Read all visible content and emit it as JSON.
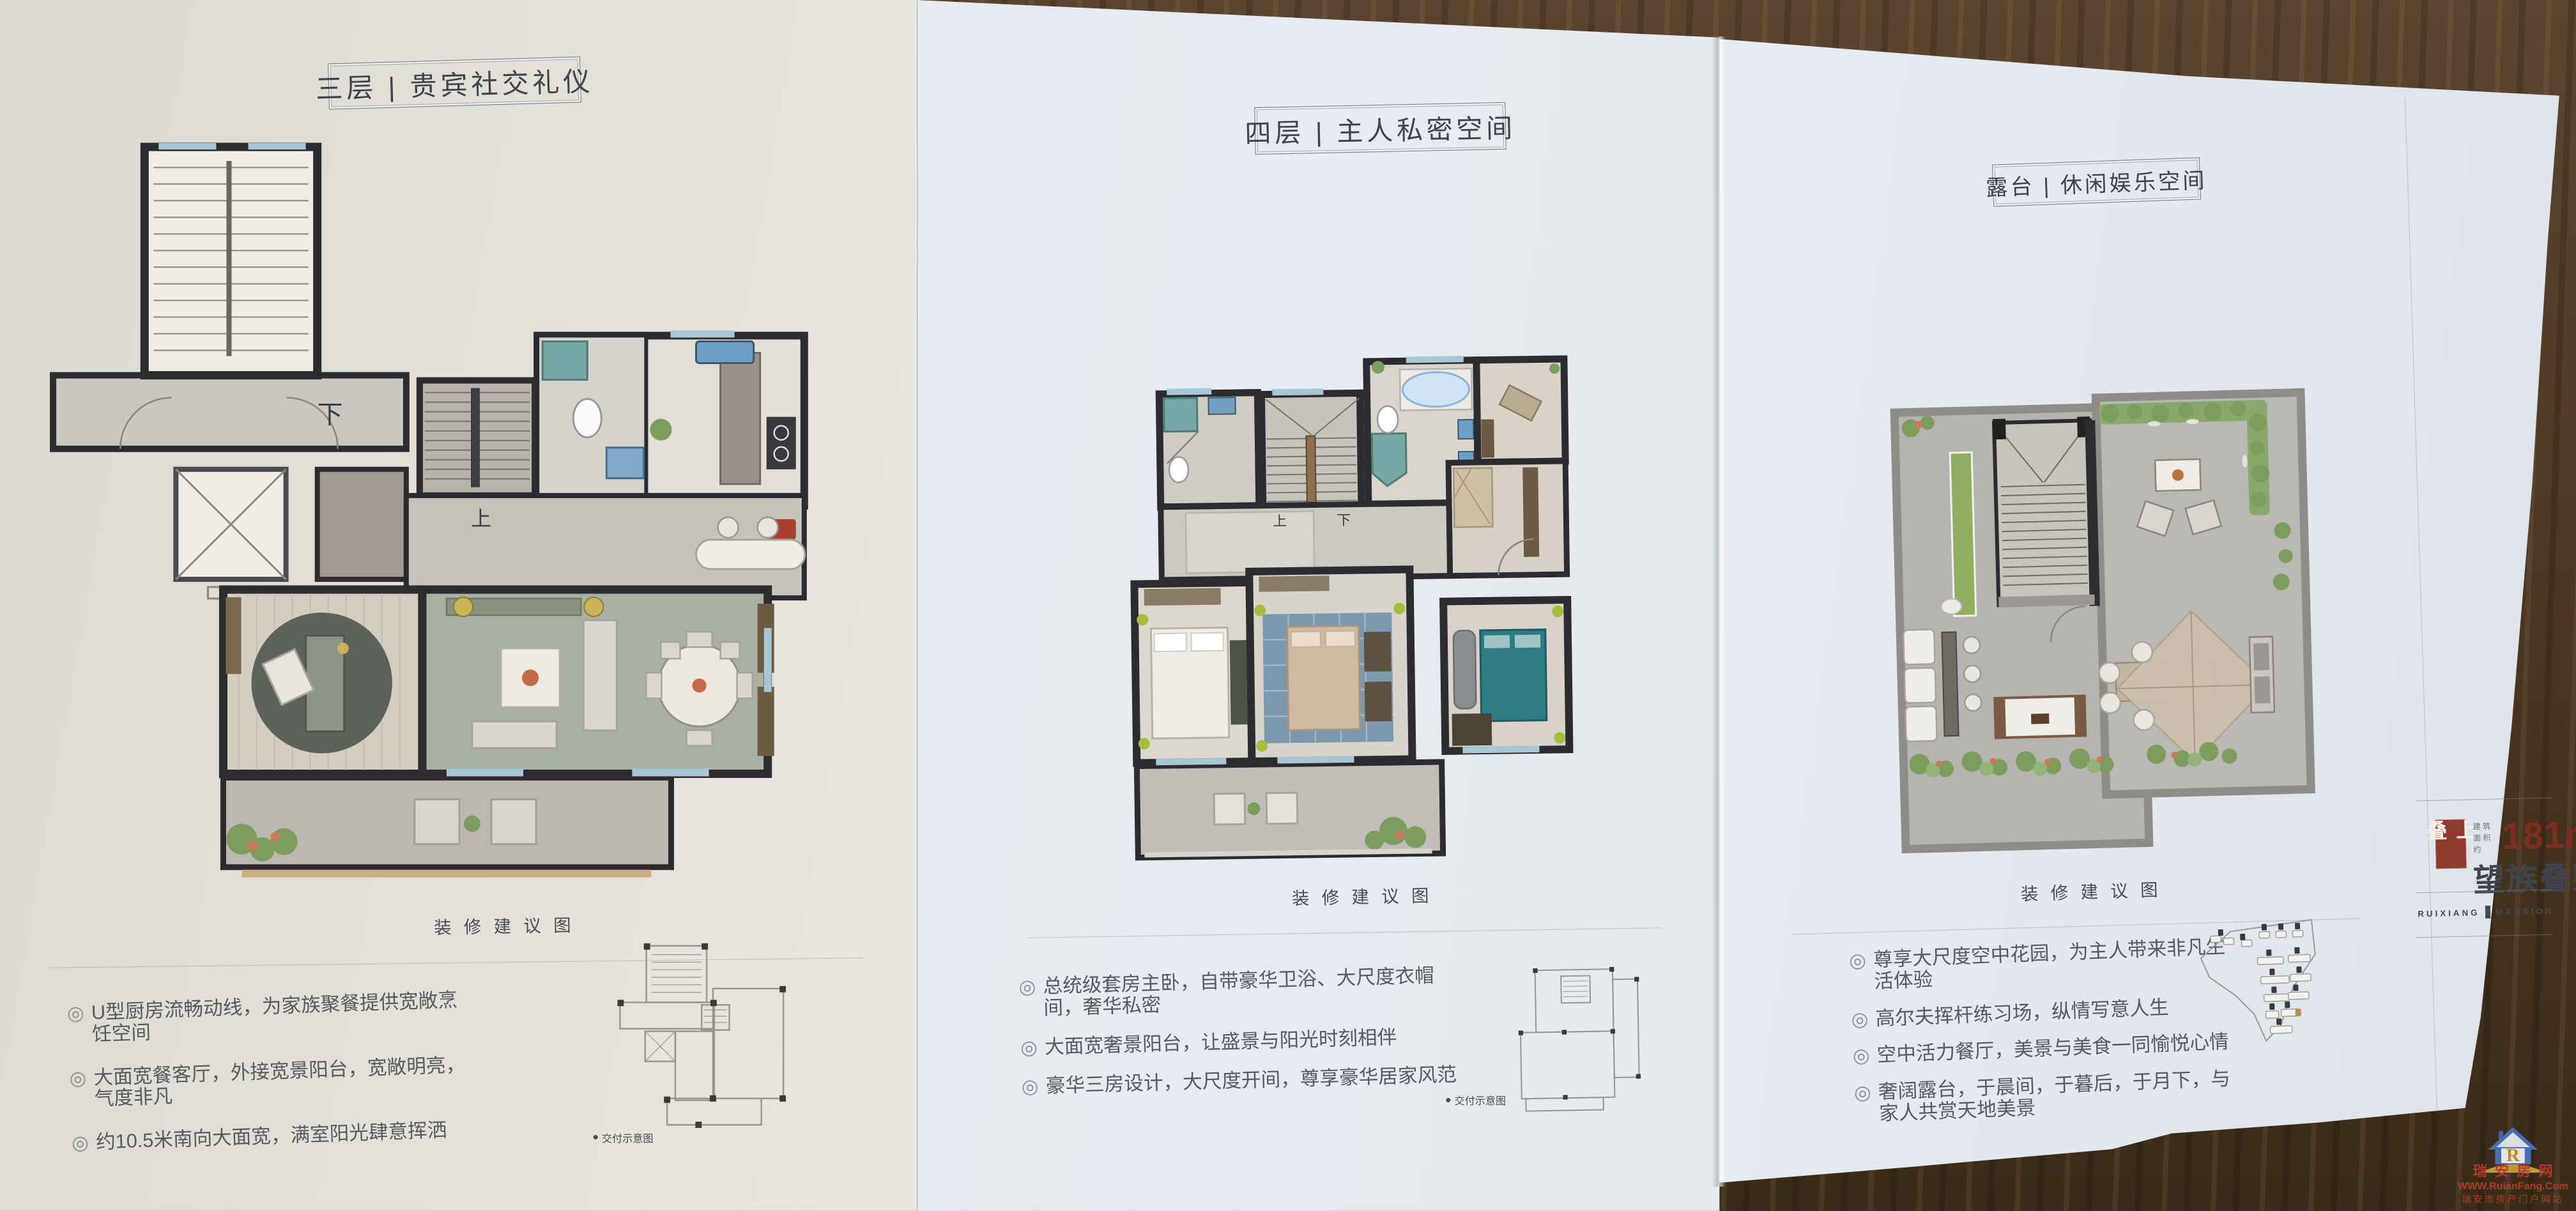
{
  "bullet_marker": "◎",
  "mini_marker": "●",
  "pages": [
    {
      "title": "三层 | 贵宾社交礼仪",
      "caption": "装修建议图",
      "bullets": [
        "U型厨房流畅动线，为家族聚餐提供宽敞烹饪空间",
        "大面宽餐客厅，外接宽景阳台，宽敞明亮，气度非凡",
        "约10.5米南向大面宽，满室阳光肆意挥洒"
      ],
      "mini_label": "交付示意图",
      "plan_labels": {
        "down": "下",
        "up": "上"
      }
    },
    {
      "title": "四层 | 主人私密空间",
      "caption": "装修建议图",
      "bullets": [
        "总统级套房主卧，自带豪华卫浴、大尺度衣帽间，奢华私密",
        "大面宽奢景阳台，让盛景与阳光时刻相伴",
        "豪华三房设计，大尺度开间，尊享豪华居家风范"
      ],
      "mini_label": "交付示意图",
      "plan_labels": {
        "up": "上",
        "down": "下"
      }
    },
    {
      "title": "露台 | 休闲娱乐空间",
      "caption": "装修建议图",
      "bullets": [
        "尊享大尺度空中花园，为主人带来非凡生活体验",
        "高尔夫挥杆练习场，纵情写意人生",
        "空中活力餐厅，美景与美食一同愉悦心情",
        "奢阔露台，于晨间，于暮后，于月下，与家人共赏天地美景"
      ]
    }
  ],
  "info_panel": {
    "badge": "上叠",
    "area_prefix": "建筑面积约",
    "area_value": "181m",
    "area_sup": "2",
    "product_name": "望族叠墅",
    "brand_left": "RUIXIANG",
    "brand_right": "MANSION"
  },
  "watermark": {
    "logo_letter": "R",
    "site_name": "瑞安房网",
    "site_url": "WWW.RuianFang.Com",
    "site_slogan": "瑞安市房产门户网站"
  },
  "colors": {
    "accent_red": "#8e3a2c",
    "maroon_text": "#7c2d22",
    "ink": "#3e434c",
    "wood": "#4f3b27",
    "wall": "#2b2b30",
    "window_blue": "#a9c6d4",
    "floor_green": "#a7b0a2",
    "plant_green": "#7d9c5e",
    "teal": "#74a8a4"
  }
}
